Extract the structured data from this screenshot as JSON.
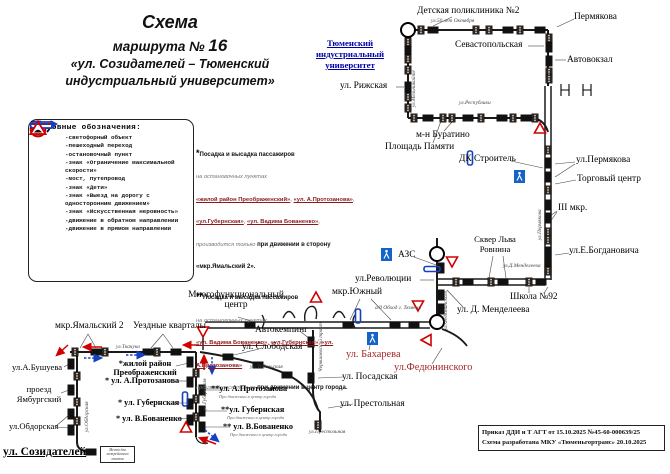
{
  "title": {
    "l1": "Схема",
    "l2a": "маршрута № ",
    "l2b": "16",
    "l3": "«ул. Созидателей – Тюменский",
    "l4": "индустриальный университет»"
  },
  "legend": {
    "title": "Условные обозначения:",
    "items": [
      {
        "icon": "traffic-light-icon",
        "label": "-светофорный объект"
      },
      {
        "icon": "pedestrian-crossing-icon",
        "label": "-пешеходный переход"
      },
      {
        "icon": "stop-point-icon",
        "label": "-остановочный пункт"
      },
      {
        "icon": "speed-limit-40-icon",
        "label": "-знак «Ограничение максимальной скорости»"
      },
      {
        "icon": "bridge-icon",
        "label": "-мост, путепровод"
      },
      {
        "icon": "children-sign-icon",
        "label": "-знак «Дети»"
      },
      {
        "icon": "oneway-sign-icon",
        "label": "-знак «Выезд на дорогу с односторонним движением»"
      },
      {
        "icon": "bump-sign-icon",
        "label": "-знак «Искусственная неровность»"
      },
      {
        "icon": "arrow-back-icon",
        "label": "-движение в обратном направлении"
      },
      {
        "icon": "arrow-forward-icon",
        "label": "-движение в прямом направлении"
      }
    ]
  },
  "notes": {
    "items": [
      {
        "star": "*",
        "lines": [
          [
            [
              "b",
              "Посадка и высадка пассажиров"
            ]
          ],
          [
            [
              "g",
              "на остановочных пунктах"
            ]
          ],
          [
            [
              "r",
              "«жилой район Преображенский»"
            ],
            [
              "p",
              ", "
            ],
            [
              "r",
              "«ул. А.Протозанова»"
            ],
            [
              "p",
              ","
            ]
          ],
          [
            [
              "r",
              "«ул.Губернская»"
            ],
            [
              "p",
              ", "
            ],
            [
              "r",
              "«ул. Вадима Бованенко»"
            ],
            [
              "p",
              ","
            ]
          ],
          [
            [
              "g",
              "производится только "
            ],
            [
              "b",
              "при движении в сторону «мкр.Ямальский 2»."
            ]
          ]
        ]
      },
      {
        "star": "**",
        "lines": [
          [
            [
              "b",
              "Посадка и высадка пассажиров"
            ]
          ],
          [
            [
              "g",
              "на остановочных пунктах"
            ]
          ],
          [
            [
              "r",
              "«ул. Вадима Бованенко»"
            ],
            [
              "p",
              ", "
            ],
            [
              "r",
              "«ул.Губернская»"
            ],
            [
              "p",
              ", "
            ],
            [
              "r",
              "«ул. А.Протозанова»"
            ]
          ],
          [
            [
              "g",
              "производится только "
            ],
            [
              "b",
              "при движении в центр города."
            ]
          ]
        ]
      }
    ]
  },
  "footer": {
    "line1": "Приказ ДДИ и Т АГТ от 15.10.2025 №45-60-000639/25",
    "line2": "Схема разработана МКУ «Тюменьгортранс» 20.10.2025"
  },
  "map": {
    "labels": [
      {
        "t": "Детская поликлиника №2",
        "x": 417,
        "y": 6,
        "c": "l2"
      },
      {
        "t": "ул.50 лет Октября",
        "x": 431,
        "y": 18,
        "c": "ti"
      },
      {
        "t": "Пермякова",
        "x": 574,
        "y": 12,
        "c": "l2"
      },
      {
        "t": "Тюменский\nиндустриальный\nуниверситет",
        "x": 306,
        "y": 38,
        "c": "univ ctr",
        "w": 88
      },
      {
        "t": "Севастопольская",
        "x": 455,
        "y": 40,
        "c": "l2"
      },
      {
        "t": "Автовокзал",
        "x": 567,
        "y": 55,
        "c": "l2"
      },
      {
        "t": "ул. Рижская",
        "x": 340,
        "y": 81,
        "c": "l2"
      },
      {
        "t": "ул.Мельникайте",
        "x": 411,
        "y": 107,
        "c": "tv"
      },
      {
        "t": "ул.Республики",
        "x": 459,
        "y": 100,
        "c": "ti"
      },
      {
        "t": "м-н Буратино",
        "x": 416,
        "y": 130,
        "c": "l2"
      },
      {
        "t": "Площадь Памяти",
        "x": 385,
        "y": 142,
        "c": "l2"
      },
      {
        "t": "ДК Строитель",
        "x": 459,
        "y": 154,
        "c": "l2"
      },
      {
        "t": "ул.Пермякова",
        "x": 576,
        "y": 155,
        "c": "l2"
      },
      {
        "t": "Торговый центр",
        "x": 577,
        "y": 174,
        "c": "l2"
      },
      {
        "t": "III мкр.",
        "x": 558,
        "y": 203,
        "c": "l2"
      },
      {
        "t": "ул.Пермякова",
        "x": 537,
        "y": 240,
        "c": "tv"
      },
      {
        "t": "Сквер Льва\nРовнина",
        "x": 466,
        "y": 234,
        "c": "l1 ctr",
        "w": 58
      },
      {
        "t": "ул.Е.Богдановича",
        "x": 569,
        "y": 246,
        "c": "l2"
      },
      {
        "t": "ул.Д.Менделеева",
        "x": 503,
        "y": 263,
        "c": "ti"
      },
      {
        "t": "Школа №92",
        "x": 510,
        "y": 292,
        "c": "l2"
      },
      {
        "t": "ул. Д. Менделеева",
        "x": 457,
        "y": 305,
        "c": "l2"
      },
      {
        "t": "АЗС",
        "x": 398,
        "y": 250,
        "c": "l2"
      },
      {
        "t": "ул.Революции",
        "x": 355,
        "y": 274,
        "c": "l2"
      },
      {
        "t": "мкр.Южный",
        "x": 332,
        "y": 287,
        "c": "l2"
      },
      {
        "t": "а/д Обход г. Тюмень",
        "x": 375,
        "y": 305,
        "c": "ti"
      },
      {
        "t": "ул.Федюнинского",
        "x": 443,
        "y": 330,
        "c": "tv"
      },
      {
        "t": "Многофункциональный\nцентр",
        "x": 180,
        "y": 290,
        "c": "l2 ctr",
        "w": 112
      },
      {
        "t": "Автокемпинг",
        "x": 255,
        "y": 325,
        "c": "l2"
      },
      {
        "t": "ул. Слободская",
        "x": 242,
        "y": 342,
        "c": "l2"
      },
      {
        "t": "ул. Бахарева",
        "x": 346,
        "y": 349,
        "c": "red"
      },
      {
        "t": "ул.Федюнинского",
        "x": 394,
        "y": 362,
        "c": "red"
      },
      {
        "t": "ул. Посадская",
        "x": 342,
        "y": 372,
        "c": "l2"
      },
      {
        "t": "ул. Престольная",
        "x": 340,
        "y": 399,
        "c": "l2"
      },
      {
        "t": "Червишевский тракт",
        "x": 318,
        "y": 372,
        "c": "tv"
      },
      {
        "t": "ул. Тобольская",
        "x": 250,
        "y": 364,
        "c": "ti"
      },
      {
        "t": "**ул. А.Протозанова",
        "x": 211,
        "y": 384,
        "c": "lb"
      },
      {
        "t": "При движении в центр города",
        "x": 219,
        "y": 394,
        "c": "sub"
      },
      {
        "t": "**ул. Губернская",
        "x": 221,
        "y": 405,
        "c": "lb"
      },
      {
        "t": "При движении в центр города",
        "x": 227,
        "y": 415,
        "c": "sub"
      },
      {
        "t": "** ул. В.Бованенко",
        "x": 223,
        "y": 422,
        "c": "lb"
      },
      {
        "t": "При движении в центр города",
        "x": 230,
        "y": 432,
        "c": "sub"
      },
      {
        "t": "ул.Престольная",
        "x": 309,
        "y": 429,
        "c": "ti"
      },
      {
        "t": "мкр.Ямальский 2",
        "x": 55,
        "y": 321,
        "c": "l2"
      },
      {
        "t": "Уездные кварталы",
        "x": 133,
        "y": 321,
        "c": "l2"
      },
      {
        "t": "ул.Ткачука",
        "x": 116,
        "y": 344,
        "c": "ti"
      },
      {
        "t": "*жилой район\nПреображенский",
        "x": 111,
        "y": 359,
        "c": "lb ctr",
        "w": 68
      },
      {
        "t": "* ул. А.Протозанова",
        "x": 105,
        "y": 376,
        "c": "lb"
      },
      {
        "t": "* ул. Губернская",
        "x": 118,
        "y": 398,
        "c": "lb"
      },
      {
        "t": "* ул. В.Бованенко",
        "x": 116,
        "y": 414,
        "c": "lb"
      },
      {
        "t": "ул.Губернская",
        "x": 202,
        "y": 410,
        "c": "tv"
      },
      {
        "t": "ул.А.Бушуева",
        "x": 12,
        "y": 362,
        "c": "l1"
      },
      {
        "t": "проезд\nЯмбургский",
        "x": 13,
        "y": 384,
        "c": "l1 ctr",
        "w": 52
      },
      {
        "t": "ул.Обдорская",
        "x": 9,
        "y": 421,
        "c": "l1"
      },
      {
        "t": "ул.Обдорская",
        "x": 84,
        "y": 432,
        "c": "tv"
      },
      {
        "t": "ул. Созидателей",
        "x": 3,
        "y": 446,
        "c": "term"
      },
      {
        "t": "Место для\nмежрейсового\nотстоя",
        "x": 100,
        "y": 446,
        "c": "boxt",
        "w": 33
      }
    ],
    "markers": [
      [
        "c",
        408,
        30
      ],
      [
        "c",
        437,
        254
      ],
      [
        "c",
        437,
        322
      ],
      [
        "s",
        433,
        30,
        "h"
      ],
      [
        "s",
        508,
        30,
        "h"
      ],
      [
        "s",
        540,
        30,
        "h"
      ],
      [
        "s",
        408,
        50,
        "v"
      ],
      [
        "s",
        408,
        87,
        "v"
      ],
      [
        "s",
        549,
        47,
        "v"
      ],
      [
        "s",
        549,
        61,
        "v"
      ],
      [
        "s",
        428,
        118,
        "h"
      ],
      [
        "s",
        468,
        118,
        "h"
      ],
      [
        "s",
        502,
        118,
        "h"
      ],
      [
        "s",
        526,
        118,
        "h"
      ],
      [
        "s",
        548,
        163,
        "v"
      ],
      [
        "s",
        548,
        177,
        "v"
      ],
      [
        "s",
        548,
        205,
        "v"
      ],
      [
        "s",
        548,
        218,
        "v"
      ],
      [
        "s",
        548,
        252,
        "v"
      ],
      [
        "s",
        548,
        263,
        "v"
      ],
      [
        "s",
        468,
        282,
        "h"
      ],
      [
        "s",
        503,
        282,
        "h"
      ],
      [
        "s",
        541,
        282,
        "h"
      ],
      [
        "s",
        441,
        268,
        "v"
      ],
      [
        "s",
        441,
        295,
        "v"
      ],
      [
        "s",
        441,
        309,
        "v"
      ],
      [
        "s",
        250,
        325,
        "h"
      ],
      [
        "s",
        348,
        325,
        "h"
      ],
      [
        "s",
        395,
        325,
        "h"
      ],
      [
        "s",
        414,
        325,
        "h"
      ],
      [
        "s",
        311,
        342,
        "v"
      ],
      [
        "s",
        311,
        378,
        "v"
      ],
      [
        "s",
        228,
        357,
        "h"
      ],
      [
        "s",
        258,
        365,
        "h"
      ],
      [
        "s",
        287,
        375,
        "h"
      ],
      [
        "s",
        96,
        352,
        "h"
      ],
      [
        "s",
        148,
        352,
        "h"
      ],
      [
        "s",
        176,
        352,
        "h"
      ],
      [
        "s",
        71,
        364,
        "v"
      ],
      [
        "s",
        71,
        390,
        "v"
      ],
      [
        "s",
        71,
        414,
        "v"
      ],
      [
        "s",
        71,
        430,
        "v"
      ],
      [
        "s",
        91,
        452,
        "h"
      ],
      [
        "s",
        190,
        362,
        "v"
      ],
      [
        "s",
        190,
        382,
        "v"
      ],
      [
        "s",
        190,
        404,
        "v"
      ],
      [
        "s",
        190,
        420,
        "v"
      ],
      [
        "s",
        202,
        390,
        "v"
      ],
      [
        "s",
        202,
        411,
        "v"
      ],
      [
        "s",
        202,
        427,
        "v"
      ],
      [
        "tl",
        421,
        30
      ],
      [
        "tl",
        476,
        30
      ],
      [
        "tl",
        489,
        30
      ],
      [
        "tl",
        520,
        30
      ],
      [
        "tl",
        549,
        38
      ],
      [
        "tl",
        408,
        42
      ],
      [
        "tl",
        408,
        59
      ],
      [
        "tl",
        408,
        70
      ],
      [
        "tl",
        408,
        97
      ],
      [
        "tl",
        408,
        108
      ],
      [
        "tl",
        549,
        72
      ],
      [
        "tl",
        549,
        79
      ],
      [
        "tl",
        414,
        118
      ],
      [
        "tl",
        443,
        118
      ],
      [
        "tl",
        452,
        118
      ],
      [
        "tl",
        481,
        118
      ],
      [
        "tl",
        513,
        118
      ],
      [
        "tl",
        535,
        118
      ],
      [
        "tl",
        548,
        150
      ],
      [
        "tl",
        548,
        190
      ],
      [
        "tl",
        548,
        232
      ],
      [
        "tl",
        548,
        240
      ],
      [
        "tl",
        548,
        271
      ],
      [
        "tl",
        456,
        282
      ],
      [
        "tl",
        491,
        282
      ],
      [
        "tl",
        529,
        282
      ],
      [
        "tl",
        75,
        352
      ],
      [
        "tl",
        105,
        352
      ],
      [
        "tl",
        157,
        352
      ],
      [
        "tl",
        77,
        376
      ],
      [
        "tl",
        77,
        402
      ],
      [
        "tl",
        77,
        421
      ],
      [
        "tl",
        196,
        373
      ],
      [
        "tl",
        196,
        399
      ],
      [
        "tl",
        196,
        417
      ],
      [
        "tl",
        318,
        425
      ],
      [
        "tri",
        540,
        129,
        "u"
      ],
      [
        "tri",
        452,
        261,
        "d"
      ],
      [
        "tri",
        418,
        305,
        "d"
      ],
      [
        "tri",
        427,
        340,
        "l"
      ],
      [
        "tri",
        316,
        298,
        "u"
      ],
      [
        "tri",
        203,
        331,
        "d"
      ],
      [
        "tri",
        186,
        428,
        "u"
      ],
      [
        "ped",
        381,
        248
      ],
      [
        "ped",
        367,
        332
      ],
      [
        "ped",
        514,
        170
      ],
      [
        "owv",
        470,
        151
      ],
      [
        "owh",
        424,
        269
      ],
      [
        "owv",
        358,
        309
      ],
      [
        "owv",
        185,
        392
      ],
      [
        "br",
        565,
        90
      ],
      [
        "br",
        587,
        90
      ]
    ],
    "arrows": [
      [
        "r",
        102,
        347,
        84,
        347
      ],
      [
        "r",
        68,
        345,
        57,
        355
      ],
      [
        "r",
        199,
        345,
        184,
        345
      ],
      [
        "r",
        204,
        370,
        204,
        356
      ],
      [
        "r",
        216,
        444,
        200,
        438
      ],
      [
        "b",
        84,
        358,
        101,
        358
      ],
      [
        "b",
        126,
        355,
        144,
        355
      ],
      [
        "b",
        212,
        357,
        212,
        373
      ],
      [
        "b",
        205,
        430,
        218,
        441
      ]
    ],
    "pointers": [
      [
        452,
        17,
        433,
        26
      ],
      [
        574,
        19,
        557,
        27
      ],
      [
        528,
        46,
        544,
        46
      ],
      [
        566,
        60,
        555,
        60
      ],
      [
        396,
        87,
        404,
        87
      ],
      [
        444,
        131,
        453,
        121
      ],
      [
        433,
        143,
        441,
        121
      ],
      [
        511,
        161,
        543,
        168
      ],
      [
        575,
        162,
        555,
        164
      ],
      [
        575,
        164,
        555,
        177
      ],
      [
        576,
        180,
        555,
        184
      ],
      [
        557,
        211,
        550,
        216
      ],
      [
        557,
        212,
        550,
        222
      ],
      [
        569,
        253,
        555,
        255
      ],
      [
        493,
        256,
        489,
        278
      ],
      [
        503,
        256,
        506,
        278
      ],
      [
        529,
        293,
        529,
        287
      ],
      [
        544,
        293,
        548,
        287
      ],
      [
        463,
        307,
        447,
        290
      ],
      [
        414,
        257,
        436,
        265
      ],
      [
        420,
        280,
        434,
        280
      ],
      [
        371,
        299,
        391,
        320
      ],
      [
        360,
        299,
        350,
        320
      ],
      [
        238,
        317,
        251,
        321
      ],
      [
        301,
        332,
        310,
        339
      ],
      [
        259,
        349,
        234,
        355
      ],
      [
        369,
        350,
        372,
        336
      ],
      [
        343,
        377,
        318,
        378
      ],
      [
        353,
        404,
        328,
        408
      ],
      [
        432,
        364,
        442,
        348
      ],
      [
        223,
        390,
        205,
        390
      ],
      [
        227,
        411,
        205,
        411
      ],
      [
        230,
        427,
        205,
        427
      ],
      [
        176,
        366,
        189,
        363
      ],
      [
        174,
        381,
        189,
        381
      ],
      [
        170,
        403,
        189,
        403
      ],
      [
        176,
        418,
        189,
        419
      ],
      [
        64,
        367,
        69,
        364
      ],
      [
        61,
        393,
        69,
        390
      ],
      [
        56,
        427,
        69,
        428
      ],
      [
        56,
        426,
        69,
        415
      ],
      [
        88,
        334,
        80,
        348
      ],
      [
        88,
        334,
        96,
        348
      ],
      [
        163,
        334,
        151,
        348
      ],
      [
        163,
        334,
        173,
        348
      ]
    ]
  }
}
